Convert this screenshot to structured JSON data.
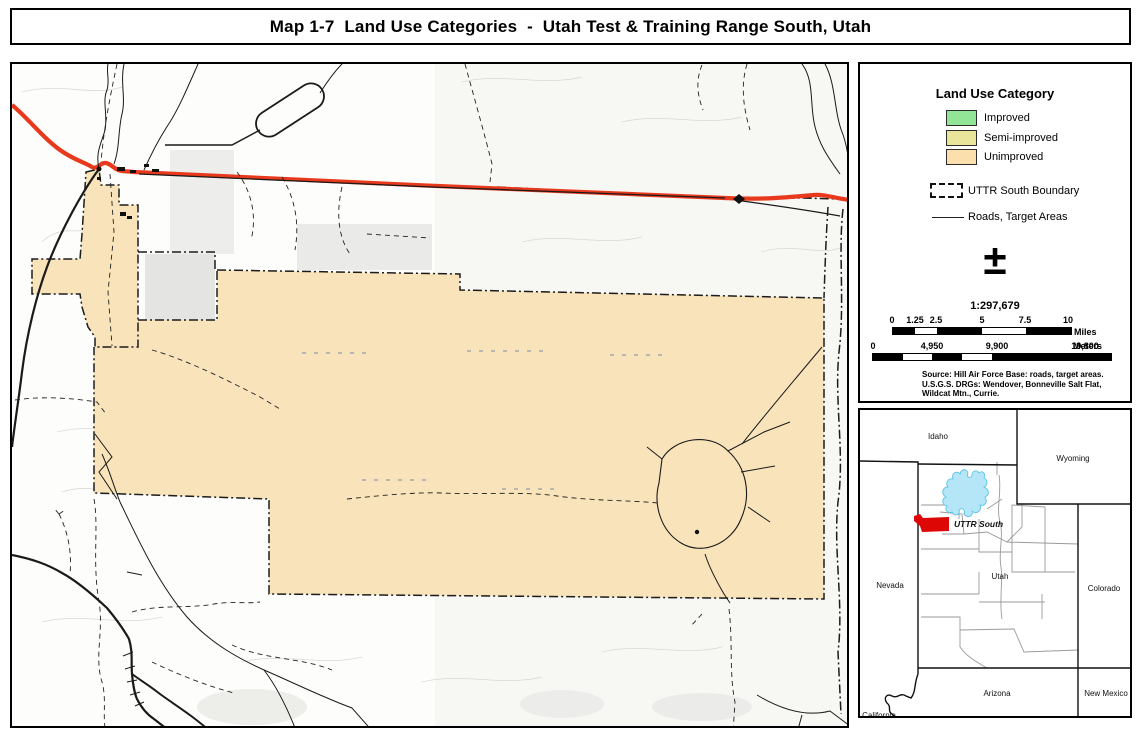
{
  "title": "Map 1-7  Land Use Categories  -  Utah Test & Training Range South, Utah",
  "legend": {
    "title": "Land Use Category",
    "items": [
      {
        "label": "Improved",
        "color": "#92E497"
      },
      {
        "label": "Semi-improved",
        "color": "#E9E69B"
      },
      {
        "label": "Unimproved",
        "color": "#FBDFAC"
      }
    ],
    "boundary_label": "UTTR South Boundary",
    "roads_label": "Roads, Target Areas",
    "north_symbol": "±"
  },
  "scale": {
    "ratio": "1:297,679",
    "miles": {
      "labels": [
        "0",
        "1.25",
        "2.5",
        "5",
        "7.5",
        "10"
      ],
      "unit": "Miles"
    },
    "meters": {
      "labels": [
        "0",
        "4,950",
        "9,900",
        "19,800"
      ],
      "unit": "Meters"
    },
    "source_lines": [
      "Source: Hill Air Force Base: roads, target areas.",
      "U.S.G.S. DRGs: Wendover, Bonneville Salt Flat,",
      "Wildcat Mtn., Currie."
    ]
  },
  "inset": {
    "states": [
      "Idaho",
      "Wyoming",
      "Nevada",
      "Utah",
      "Colorado",
      "Arizona",
      "New Mexico",
      "California"
    ],
    "uttr_label": "UTTR South"
  },
  "map_colors": {
    "unimproved_fill": "#F8E3BA",
    "highway_red": "#E8391D",
    "lake_blue": "#B5E6F7",
    "uttr_red": "#DD0806"
  }
}
